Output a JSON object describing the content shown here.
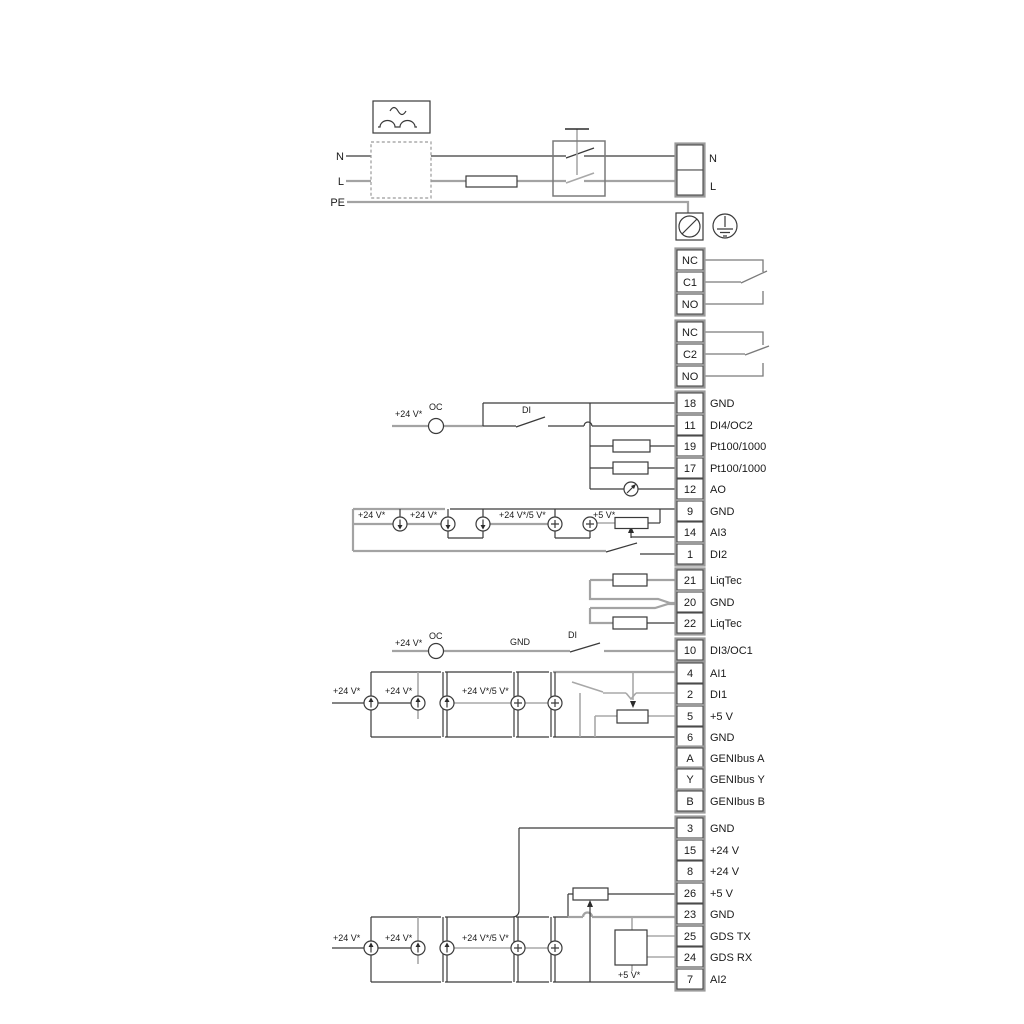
{
  "title": "Pump controller wiring diagram",
  "colors": {
    "wire_gray": "#a3a3a3",
    "wire_dark": "#3a3a3a",
    "relay_wire": "#7a7a7a",
    "frame_gray": "#9a9a9a",
    "cell_border": "#4a4a4a",
    "text": "#1a1a1a",
    "background": "#ffffff"
  },
  "power": {
    "n": "N",
    "l": "L",
    "pe": "PE",
    "n_right": "N",
    "l_right": "L"
  },
  "relay1": [
    "NC",
    "C1",
    "NO"
  ],
  "relay2": [
    "NC",
    "C2",
    "NO"
  ],
  "groupA": [
    {
      "num": "18",
      "label": "GND"
    },
    {
      "num": "11",
      "label": "DI4/OC2"
    },
    {
      "num": "19",
      "label": "Pt100/1000"
    },
    {
      "num": "17",
      "label": "Pt100/1000"
    },
    {
      "num": "12",
      "label": "AO"
    },
    {
      "num": "9",
      "label": "GND"
    },
    {
      "num": "14",
      "label": "AI3"
    },
    {
      "num": "1",
      "label": "DI2"
    }
  ],
  "groupB": [
    {
      "num": "21",
      "label": "LiqTec"
    },
    {
      "num": "20",
      "label": "GND"
    },
    {
      "num": "22",
      "label": "LiqTec"
    }
  ],
  "groupC": [
    {
      "num": "10",
      "label": "DI3/OC1"
    }
  ],
  "groupD": [
    {
      "num": "4",
      "label": "AI1"
    },
    {
      "num": "2",
      "label": "DI1"
    },
    {
      "num": "5",
      "label": "+5 V"
    },
    {
      "num": "6",
      "label": "GND"
    }
  ],
  "genibus": [
    {
      "num": "A",
      "label": "GENIbus A"
    },
    {
      "num": "Y",
      "label": "GENIbus Y"
    },
    {
      "num": "B",
      "label": "GENIbus B"
    }
  ],
  "groupE": [
    {
      "num": "3",
      "label": "GND"
    },
    {
      "num": "15",
      "label": "+24 V"
    },
    {
      "num": "8",
      "label": "+24 V"
    },
    {
      "num": "26",
      "label": "+5 V"
    },
    {
      "num": "23",
      "label": "GND"
    },
    {
      "num": "25",
      "label": "GDS TX"
    },
    {
      "num": "24",
      "label": "GDS RX"
    },
    {
      "num": "7",
      "label": "AI2"
    }
  ],
  "ann": {
    "v24": "+24 V*",
    "v24v5": "+24 V*/5 V*",
    "v5": "+5 V*",
    "oc": "OC",
    "di": "DI",
    "gnd": "GND"
  }
}
